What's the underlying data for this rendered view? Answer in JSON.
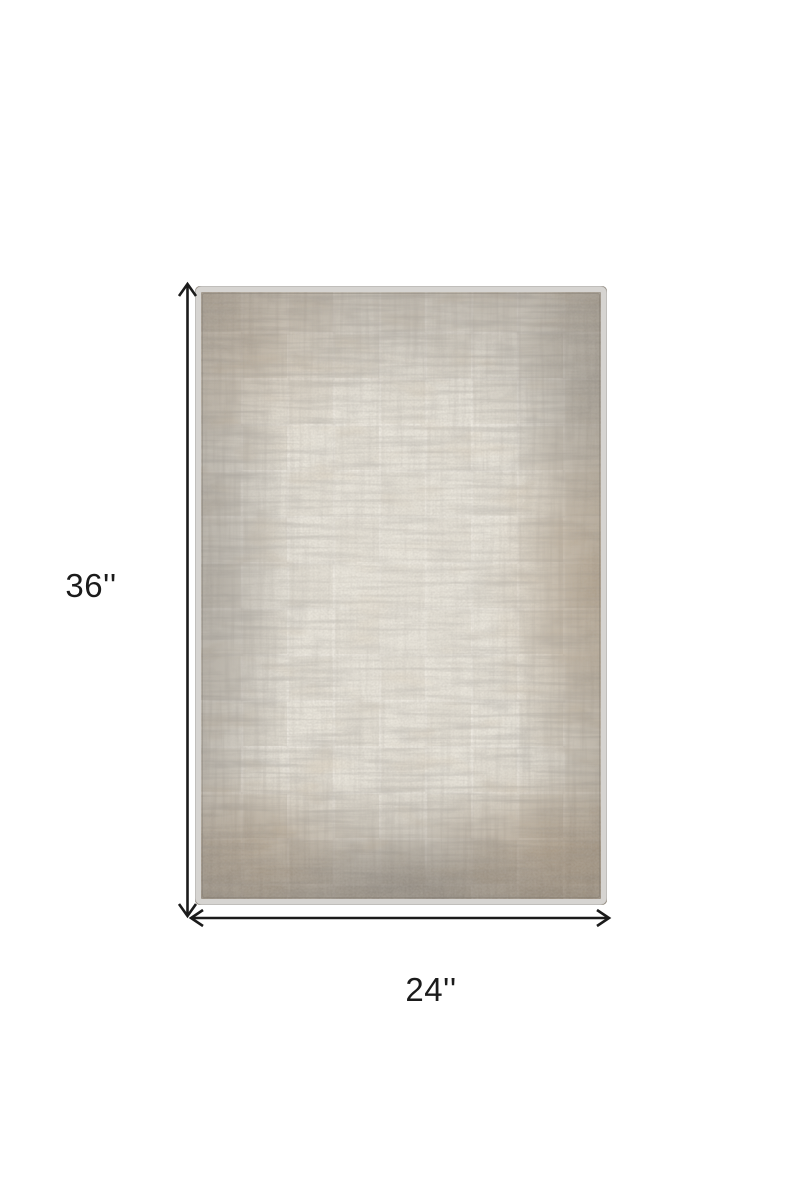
{
  "canvas": {
    "background": "#ffffff"
  },
  "dimensions": {
    "height_label": "36''",
    "width_label": "24''",
    "arrow_color": "#1b1b1b"
  },
  "rug": {
    "colors": {
      "base": "#e8e4da",
      "binding": "#d6d4d1",
      "gray_streak": "#8f8881",
      "dark_gray": "#6e6862",
      "taupe": "#a89d8d",
      "tan": "#9a7d5b",
      "brown": "#7b6a55"
    }
  }
}
